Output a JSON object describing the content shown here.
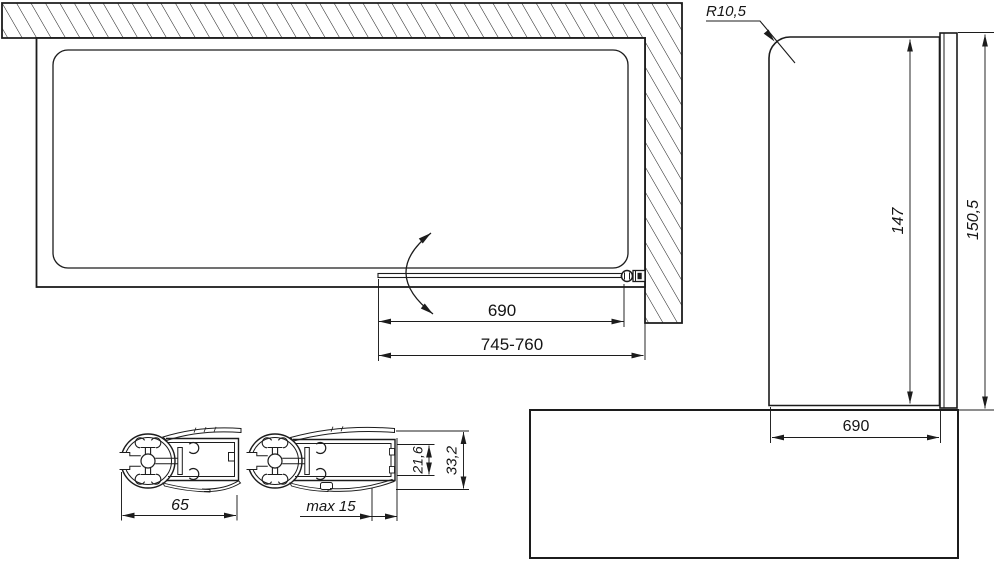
{
  "colors": {
    "line": "#1c1c1c",
    "background": "#ffffff"
  },
  "top_view": {
    "dim_glass_width": "690",
    "dim_total_width": "745-760"
  },
  "front_view": {
    "corner_radius_label": "R10,5",
    "dim_glass_height": "147",
    "dim_total_height": "150,5",
    "dim_glass_width": "690"
  },
  "profile_section": {
    "dim_profile_width": "65",
    "dim_adjustment_range": "max 15",
    "dim_channel_inner_height": "21,6",
    "dim_profile_total_height": "33,2"
  }
}
